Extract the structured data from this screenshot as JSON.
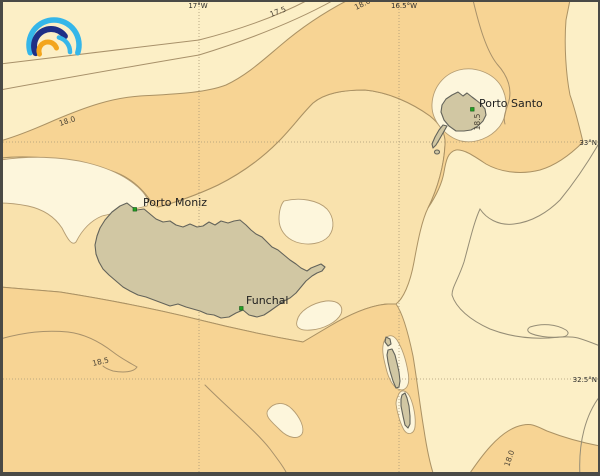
{
  "map": {
    "type": "contour-map",
    "area": "Madeira archipelago"
  },
  "grid": {
    "meridians": [
      {
        "label": "17°W"
      },
      {
        "label": "16.5°W"
      }
    ],
    "parallels": [
      {
        "label": "33°N"
      },
      {
        "label": "32.5°N"
      }
    ]
  },
  "places": [
    {
      "name": "Porto Moniz"
    },
    {
      "name": "Funchal"
    },
    {
      "name": "Porto Santo"
    }
  ],
  "contours": {
    "labels": [
      {
        "text": "17.5"
      },
      {
        "text": "18.0"
      },
      {
        "text": "18.0"
      },
      {
        "text": "18.5"
      },
      {
        "text": "18.0"
      },
      {
        "text": "18.5"
      }
    ]
  },
  "colors": {
    "sea_pale": "#fdf6dc",
    "sea_cream": "#fcefc6",
    "sea_tan": "#f9e2ad",
    "sea_orange": "#f7d494",
    "island_fill": "#d1c7a3",
    "contour_line": "#a8916a",
    "marker_green": "#23a322",
    "logo_cyan": "#35b6e9",
    "logo_blue": "#1f2f86",
    "logo_orange": "#f3a51d"
  }
}
